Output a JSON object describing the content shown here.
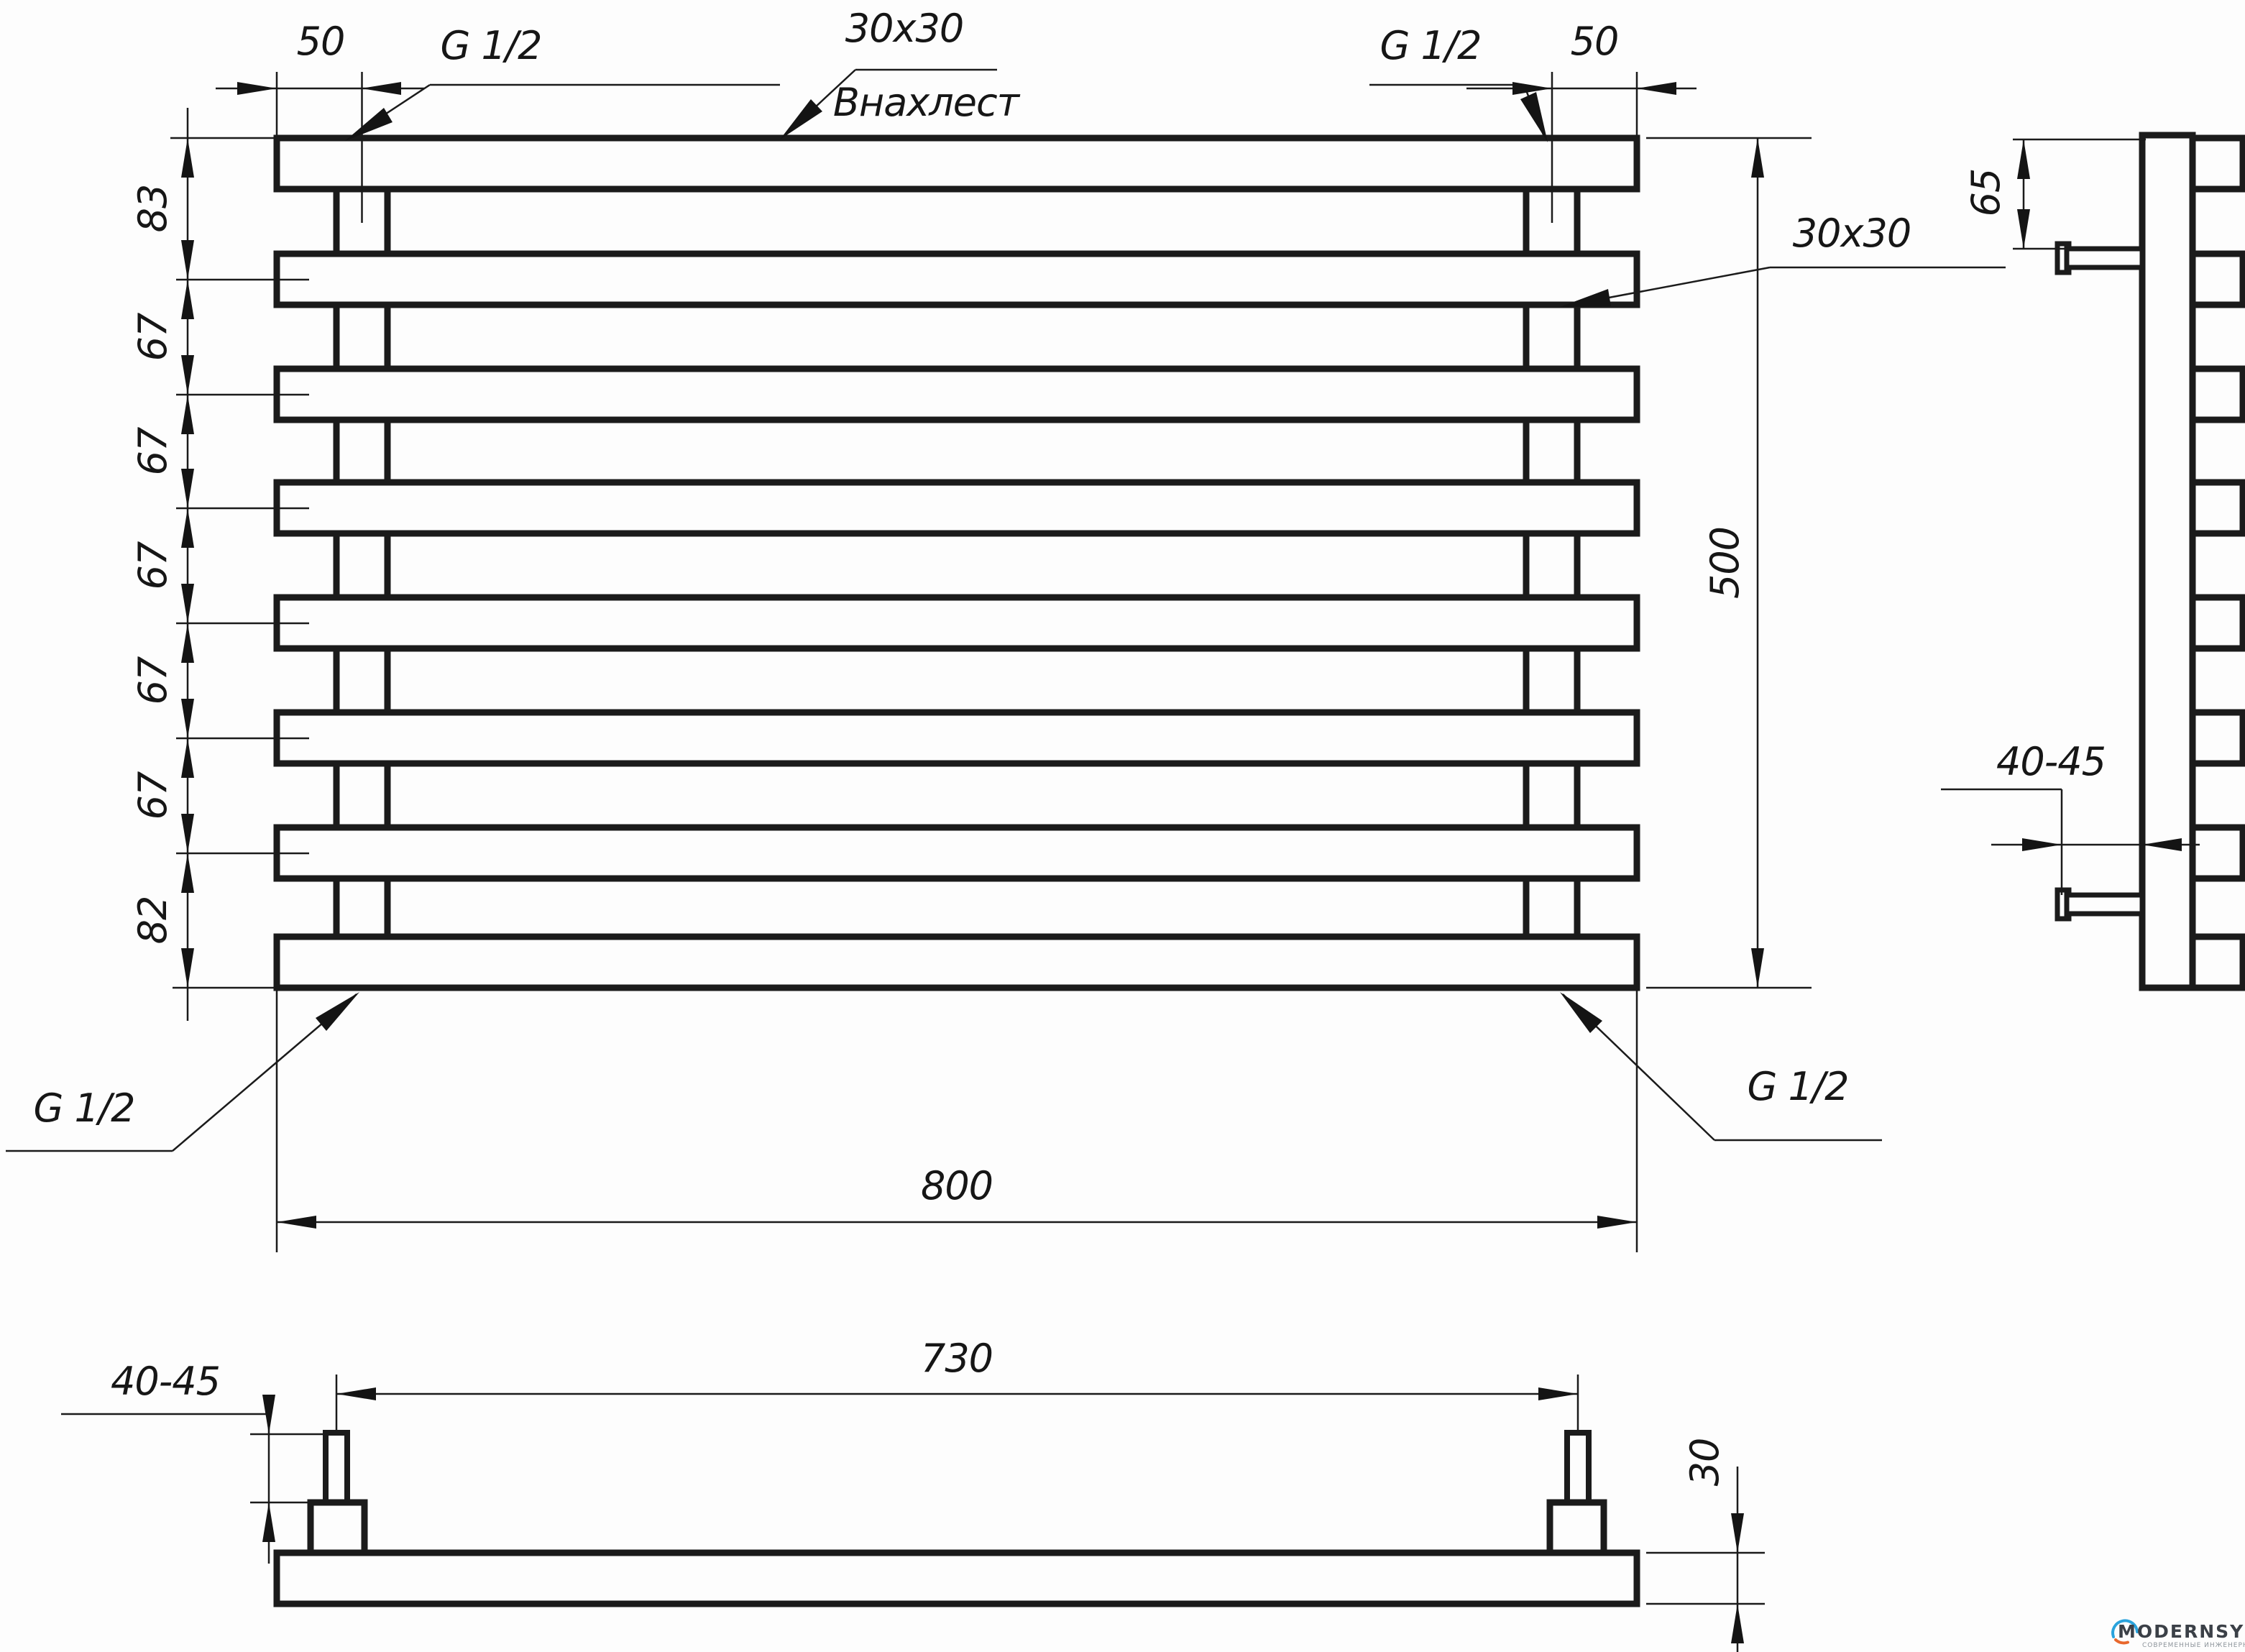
{
  "front_view": {
    "offset_left": "50",
    "offset_right": "50",
    "thread_top_left": "G 1/2",
    "thread_top_right": "G 1/2",
    "thread_bottom_left": "G 1/2",
    "thread_bottom_right": "G 1/2",
    "tube_note_top": "30x30",
    "tube_note_top_caption": "Внахлест",
    "tube_note_right": "30x30",
    "total_height": "500",
    "total_width": "800",
    "row_spacings": [
      "83",
      "67",
      "67",
      "67",
      "67",
      "67",
      "82"
    ]
  },
  "side_view": {
    "top_bracket_offset": "65",
    "wall_clearance": "40-45"
  },
  "bottom_view": {
    "bracket_stud_height": "40-45",
    "bracket_spacing": "730",
    "tube_depth": "30"
  },
  "logo": {
    "brand": "MODERNSYS",
    "tagline": "СОВРЕМЕННЫЕ ИНЖЕНЕРНЫЕ СИСТЕМЫ"
  }
}
